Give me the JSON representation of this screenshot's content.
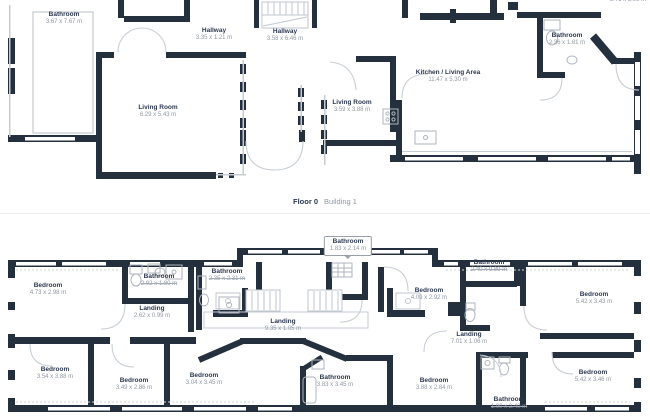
{
  "section_divider": {
    "floor_label": "Floor 0",
    "building_label": "Building 1"
  },
  "colors": {
    "wall": "#25303E",
    "room_name": "#2C3850",
    "dims_text": "#9097A2",
    "light_line": "#C5CBD3"
  },
  "floor0": {
    "rooms": [
      {
        "name": "Bathroom",
        "dims": "3.67 x 7.67 m"
      },
      {
        "name": "Hallway",
        "dims": "3.35 x 1.21 m"
      },
      {
        "name": "Hallway",
        "dims": "3.58 x 6.46 m"
      },
      {
        "name": "Living Room",
        "dims": "6.29 x 5.43 m"
      },
      {
        "name": "Living Room",
        "dims": "3.59 x 3.88 m"
      },
      {
        "name": "Kitchen / Living Area",
        "dims": "11.47 x 5.30 m"
      },
      {
        "name": "Bathroom",
        "dims": "2.36 x 1.81 m"
      },
      {
        "name": "",
        "dims": "3.71 x 3.98 m"
      }
    ]
  },
  "floor1": {
    "rooms": [
      {
        "name": "Bedroom",
        "dims": "4.73 x 2.98 m"
      },
      {
        "name": "Bathroom",
        "dims": "2.92 x 1.80 m"
      },
      {
        "name": "Landing",
        "dims": "2.62 x 0.99 m"
      },
      {
        "name": "Bathroom",
        "dims": "2.35 x 2.31 m"
      },
      {
        "name": "Landing",
        "dims": "9.35 x 1.05 m"
      },
      {
        "name": "Bedroom",
        "dims": "4.09 x 2.92 m"
      },
      {
        "name": "Bathroom",
        "dims": "2.40 x 0.89 m"
      },
      {
        "name": "Bedroom",
        "dims": "5.42 x 3.43 m"
      },
      {
        "name": "Landing",
        "dims": "7.01 x 1.06 m"
      },
      {
        "name": "Bedroom",
        "dims": "3.54 x 3.88 m"
      },
      {
        "name": "Bedroom",
        "dims": "3.49 x 2.86 m"
      },
      {
        "name": "Bedroom",
        "dims": "3.04 x 3.45 m"
      },
      {
        "name": "Bathroom",
        "dims": "3.83 x 3.45 m"
      },
      {
        "name": "Bedroom",
        "dims": "3.88 x 2.84 m"
      },
      {
        "name": "Bathroom",
        "dims": "1.90 x 2.40 m"
      },
      {
        "name": "Bedroom",
        "dims": "5.42 x 3.46 m"
      }
    ],
    "callout": {
      "name": "Bathroom",
      "dims": "1.83 x 2.14 m"
    }
  }
}
